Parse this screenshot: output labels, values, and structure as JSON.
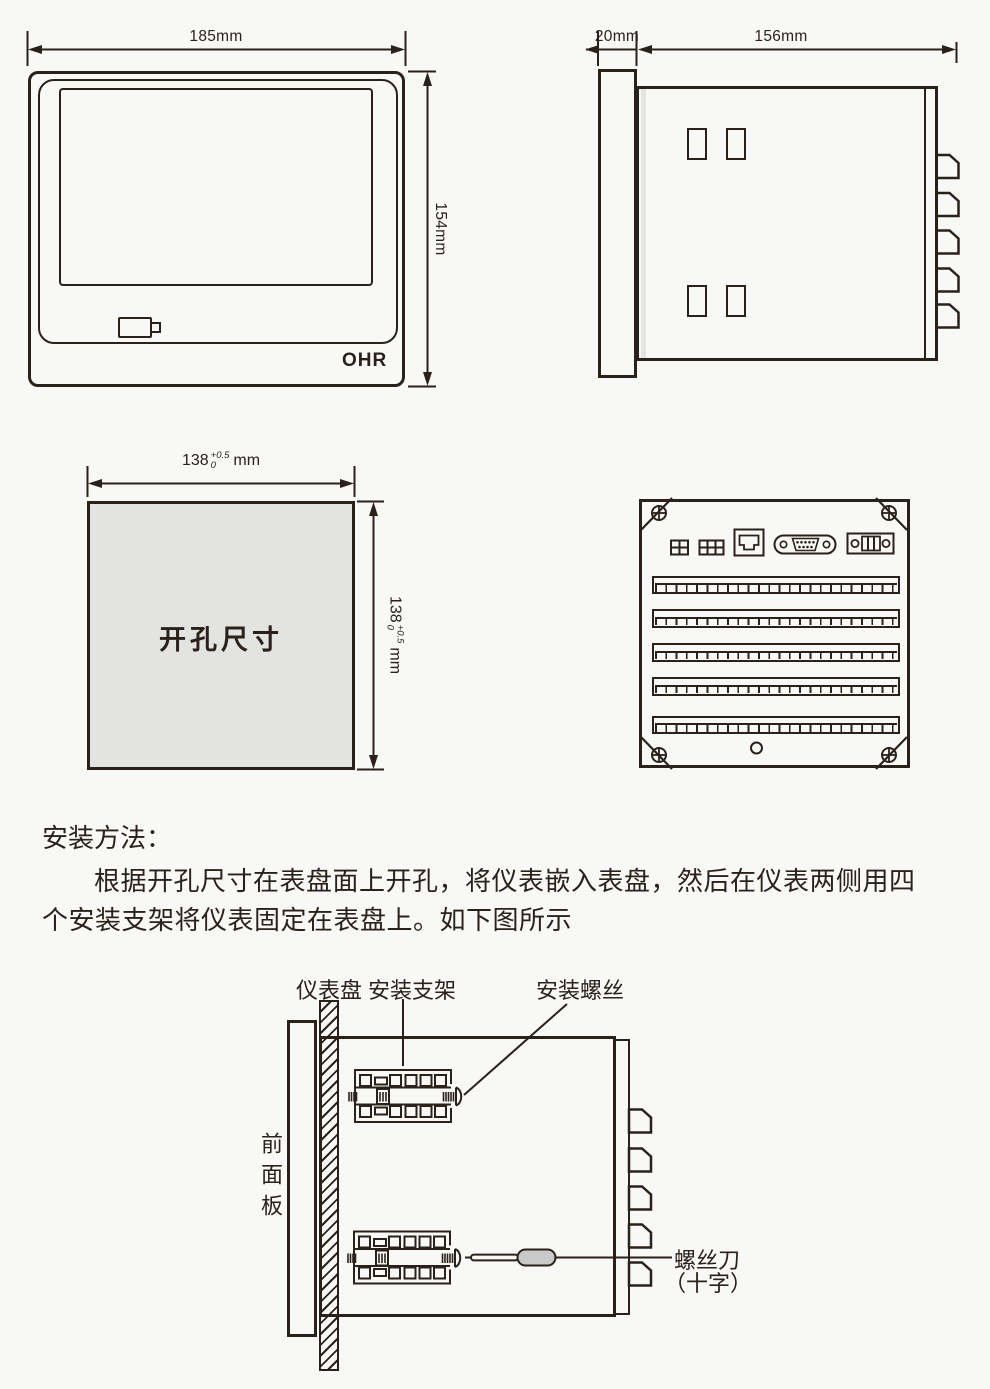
{
  "colors": {
    "ink": "#2b211b",
    "background": "#f8f8f6",
    "cutout_fill": "#e3e3e2",
    "screwdriver_handle": "#c9c9c9"
  },
  "front_view": {
    "width_dim": "185mm",
    "height_dim": "154mm",
    "logo": "OHR"
  },
  "side_view": {
    "bezel_dim": "20mm",
    "depth_dim": "156mm"
  },
  "cutout_view": {
    "label": "开孔尺寸",
    "h_dim": {
      "base": "138",
      "sup": "+0.5",
      "sub": "0",
      "unit": "mm"
    },
    "v_dim": {
      "base": "138",
      "sup": "+0.5",
      "sub": "0",
      "unit": "mm"
    }
  },
  "instructions": {
    "heading": "安装方法：",
    "lines": [
      "根据开孔尺寸在表盘面上开孔，将仪表嵌入表盘，然后在仪表两侧用四",
      "个安装支架将仪表固定在表盘上。如下图所示"
    ]
  },
  "mount_diagram": {
    "panel_label": "仪表盘",
    "bracket_label": "安装支架",
    "screw_label": "安装螺丝",
    "front_panel_label": "前面板",
    "screwdriver_label": "螺丝刀",
    "screwdriver_type_label": "（十字）"
  }
}
